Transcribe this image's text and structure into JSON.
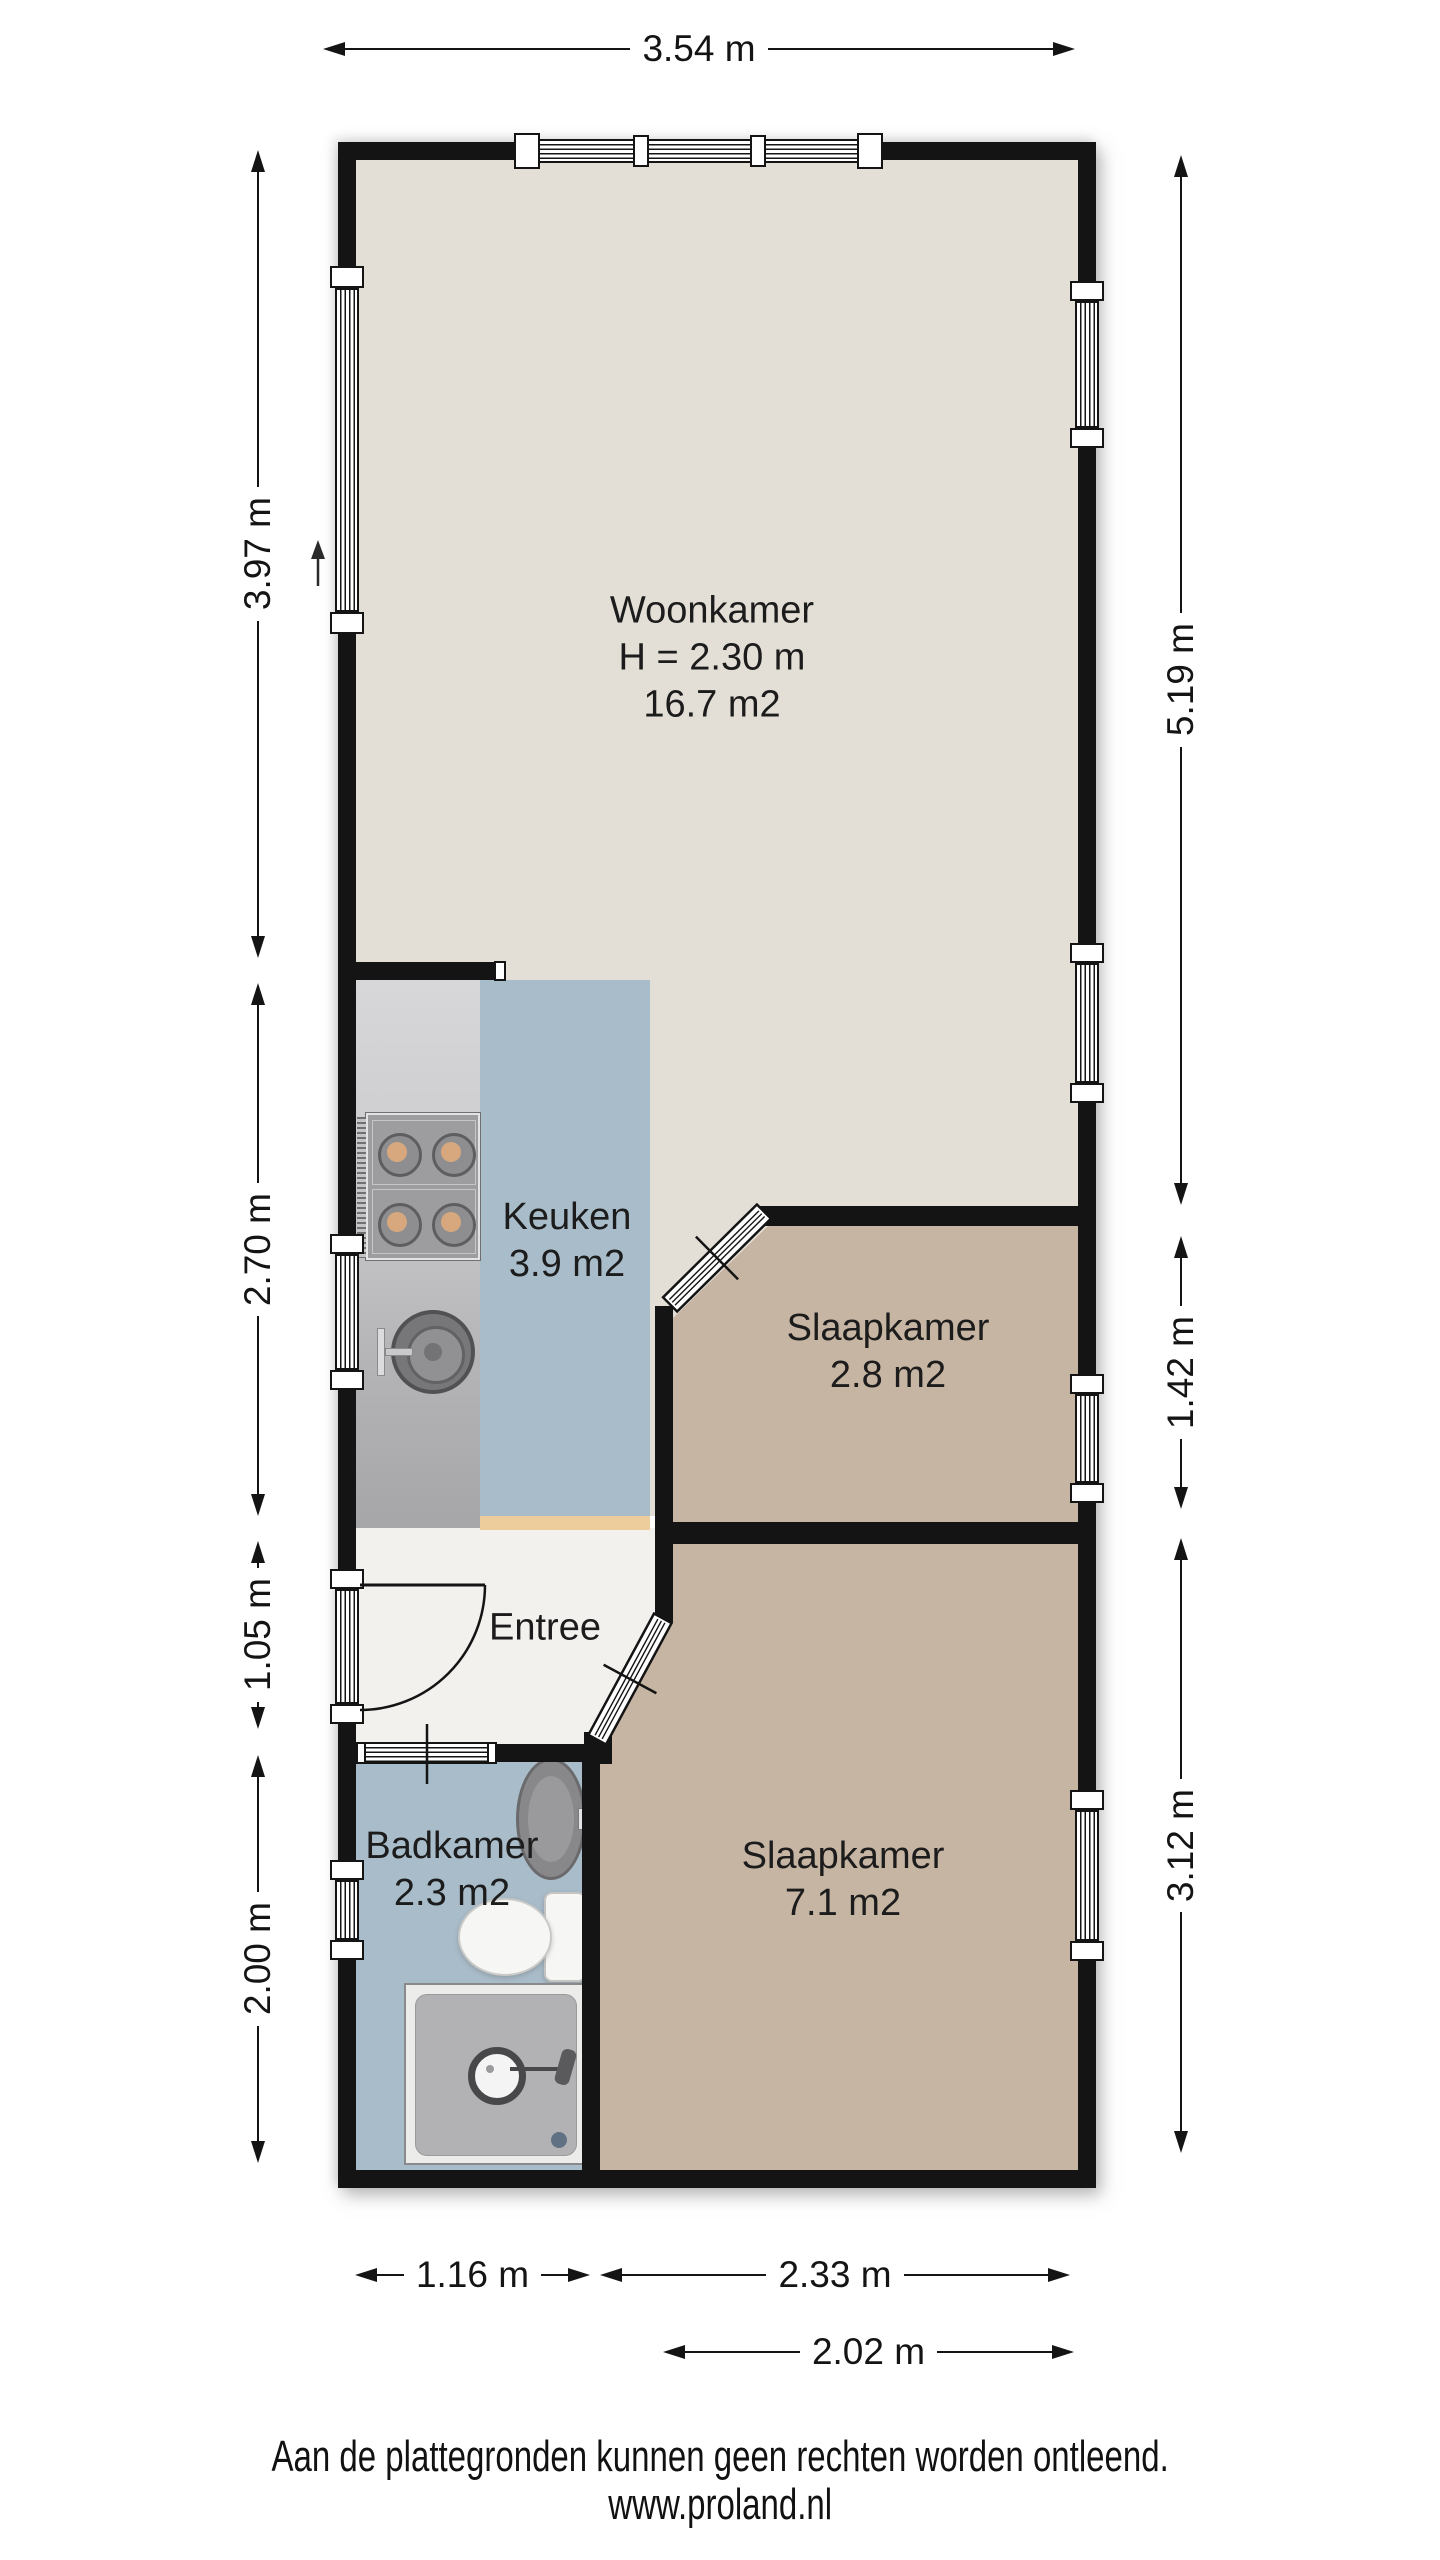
{
  "title": "Plattegrond",
  "rooms": [
    {
      "name": "Woonkamer",
      "line2": "H = 2.30 m",
      "line3": "16.7 m2"
    },
    {
      "name": "Keuken",
      "line2": "3.9 m2"
    },
    {
      "name": "Slaapkamer",
      "line2": "2.8 m2"
    },
    {
      "name": "Entree"
    },
    {
      "name": "Badkamer",
      "line2": "2.3 m2"
    },
    {
      "name": "Slaapkamer",
      "line2": "7.1 m2"
    }
  ],
  "dimensions": {
    "top": [
      {
        "label": "3.54 m"
      }
    ],
    "left": [
      {
        "label": "3.97 m"
      },
      {
        "label": "2.70 m"
      },
      {
        "label": "1.05 m"
      },
      {
        "label": "2.00 m"
      }
    ],
    "right": [
      {
        "label": "5.19 m"
      },
      {
        "label": "1.42 m"
      },
      {
        "label": "3.12 m"
      }
    ],
    "bottom": [
      {
        "label": "1.16 m"
      },
      {
        "label": "2.33 m"
      },
      {
        "label": "2.02 m"
      }
    ]
  },
  "footer": {
    "line1": "Aan de plattegronden kunnen geen rechten worden ontleend.",
    "line2": "www.proland.nl"
  },
  "icons": {
    "north_arrow": "up-arrow",
    "fixtures": [
      "stove",
      "kitchen-sink",
      "washbasin",
      "toilet",
      "shower"
    ]
  },
  "colors": {
    "wall": "#141414",
    "ink": "#141414",
    "floor_living": "#e4dfd6",
    "floor_bedroom": "#c6b5a3",
    "floor_wet": "#a9bcc9",
    "floor_hall": "#f2f1ee",
    "counter_top": "#d7d7d9",
    "counter_bottom": "#a6a6a8",
    "threshold": "#edcd9b",
    "stove_body": "#9d9da0",
    "burner": "#d7a87e"
  }
}
